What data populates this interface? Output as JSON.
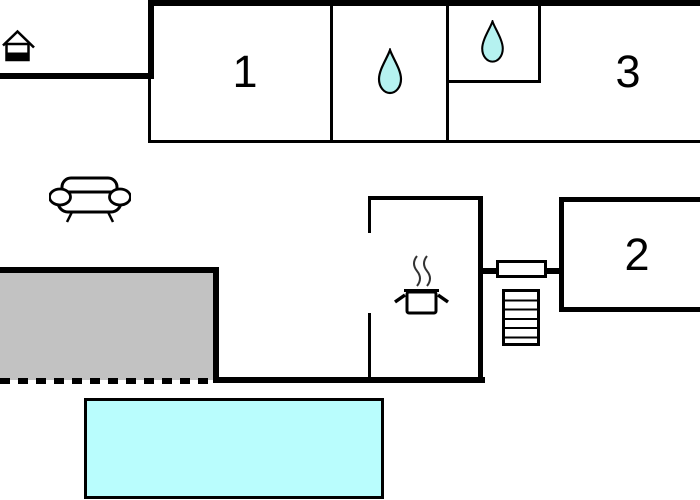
{
  "floorplan": {
    "room_labels": {
      "room1": "1",
      "room2": "2",
      "room3": "3"
    },
    "icons": {
      "entrance": "house-icon",
      "bathroom_main": "water-drop-icon",
      "bathroom_small": "water-drop-icon",
      "kitchen": "cooking-pot-icon",
      "living_area": "sofa-icon",
      "stairs": "stairs-icon",
      "radiator": "radiator-block"
    },
    "colors": {
      "wall": "#000000",
      "background": "#ffffff",
      "terrace_fill": "#c2c2c2",
      "pool_fill": "#b9fdfd",
      "water_drop_fill": "#b5f2f0"
    }
  }
}
